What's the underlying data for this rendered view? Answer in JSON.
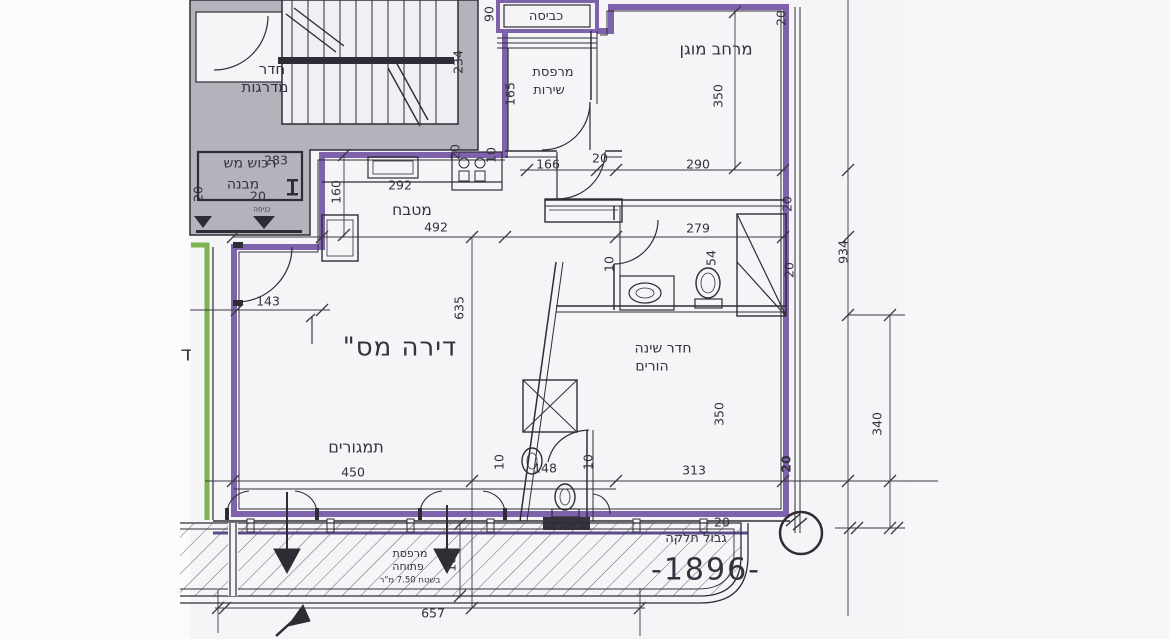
{
  "document": {
    "kind": "scanned architectural floor plan",
    "language": "Hebrew",
    "plot_number": "-1896-"
  },
  "colors": {
    "apartment_boundary_purple": "#7e62ab",
    "boundary_purple_dark": "#5e4b8b",
    "adjacent_unit_green": "#7cb450",
    "wall_fill_gray": "#b5b2bc",
    "line_black": "#2e2d36",
    "paper": "#f5f5f7"
  },
  "labels": {
    "stairwell_l1": "חדר",
    "stairwell_l2": "מדרגות",
    "common_property_l1": "רכוש מש",
    "common_property_l2": "מבנה",
    "entrance": "כניסה",
    "laundry": "כביסה",
    "service_balcony_l1": "מרפסת",
    "service_balcony_l2": "שירות",
    "protected_space": "מרחב מוגן",
    "kitchen": "מטבח",
    "apartment_title": "דירה מס\"",
    "parents_bedroom_l1": "חדר שינה",
    "parents_bedroom_l2": "הורים",
    "living_area": "תמגורים",
    "open_balcony_l1": "מרפסת",
    "open_balcony_l2": "פתוחה",
    "open_balcony_l3": "בשטח 7.50 מ\"ר",
    "plot_boundary": "גבול חלקה",
    "plot_number": "-1896-",
    "edge_partial_glyph": "ד"
  },
  "dimensions": [
    {
      "t": "234",
      "x": 458,
      "y": 62,
      "rot": true
    },
    {
      "t": "283",
      "x": 276,
      "y": 160,
      "rot": false
    },
    {
      "t": "90",
      "x": 489,
      "y": 14,
      "rot": true
    },
    {
      "t": "165",
      "x": 510,
      "y": 94,
      "rot": true
    },
    {
      "t": "20",
      "x": 198,
      "y": 194,
      "rot": true
    },
    {
      "t": "20",
      "x": 258,
      "y": 196,
      "rot": false
    },
    {
      "t": "160",
      "x": 336,
      "y": 192,
      "rot": true
    },
    {
      "t": "292",
      "x": 400,
      "y": 185,
      "rot": false
    },
    {
      "t": "20",
      "x": 455,
      "y": 152,
      "rot": true
    },
    {
      "t": "10",
      "x": 491,
      "y": 155,
      "rot": true
    },
    {
      "t": "166",
      "x": 548,
      "y": 164,
      "rot": false
    },
    {
      "t": "20",
      "x": 600,
      "y": 158,
      "rot": false
    },
    {
      "t": "290",
      "x": 698,
      "y": 164,
      "rot": false
    },
    {
      "t": "20",
      "x": 781,
      "y": 18,
      "rot": true
    },
    {
      "t": "350",
      "x": 718,
      "y": 96,
      "rot": true
    },
    {
      "t": "20",
      "x": 787,
      "y": 204,
      "rot": true
    },
    {
      "t": "934",
      "x": 843,
      "y": 252,
      "rot": true
    },
    {
      "t": "492",
      "x": 436,
      "y": 227,
      "rot": false
    },
    {
      "t": "279",
      "x": 698,
      "y": 228,
      "rot": false
    },
    {
      "t": "54",
      "x": 711,
      "y": 258,
      "rot": true
    },
    {
      "t": "20",
      "x": 789,
      "y": 270,
      "rot": true
    },
    {
      "t": "10",
      "x": 609,
      "y": 264,
      "rot": true
    },
    {
      "t": "143",
      "x": 268,
      "y": 301,
      "rot": false
    },
    {
      "t": "635",
      "x": 459,
      "y": 308,
      "rot": true
    },
    {
      "t": "350",
      "x": 719,
      "y": 414,
      "rot": true
    },
    {
      "t": "340",
      "x": 877,
      "y": 424,
      "rot": true
    },
    {
      "t": "313",
      "x": 694,
      "y": 470,
      "rot": false
    },
    {
      "t": "450",
      "x": 353,
      "y": 472,
      "rot": false
    },
    {
      "t": "10",
      "x": 499,
      "y": 462,
      "rot": true
    },
    {
      "t": "148",
      "x": 545,
      "y": 468,
      "rot": false
    },
    {
      "t": "10",
      "x": 588,
      "y": 462,
      "rot": true
    },
    {
      "t": "20",
      "x": 786,
      "y": 464,
      "rot": true,
      "bold": true
    },
    {
      "t": "20",
      "x": 722,
      "y": 522,
      "rot": false
    },
    {
      "t": "105",
      "x": 451,
      "y": 560,
      "rot": true
    },
    {
      "t": "657",
      "x": 433,
      "y": 613,
      "rot": false
    }
  ]
}
